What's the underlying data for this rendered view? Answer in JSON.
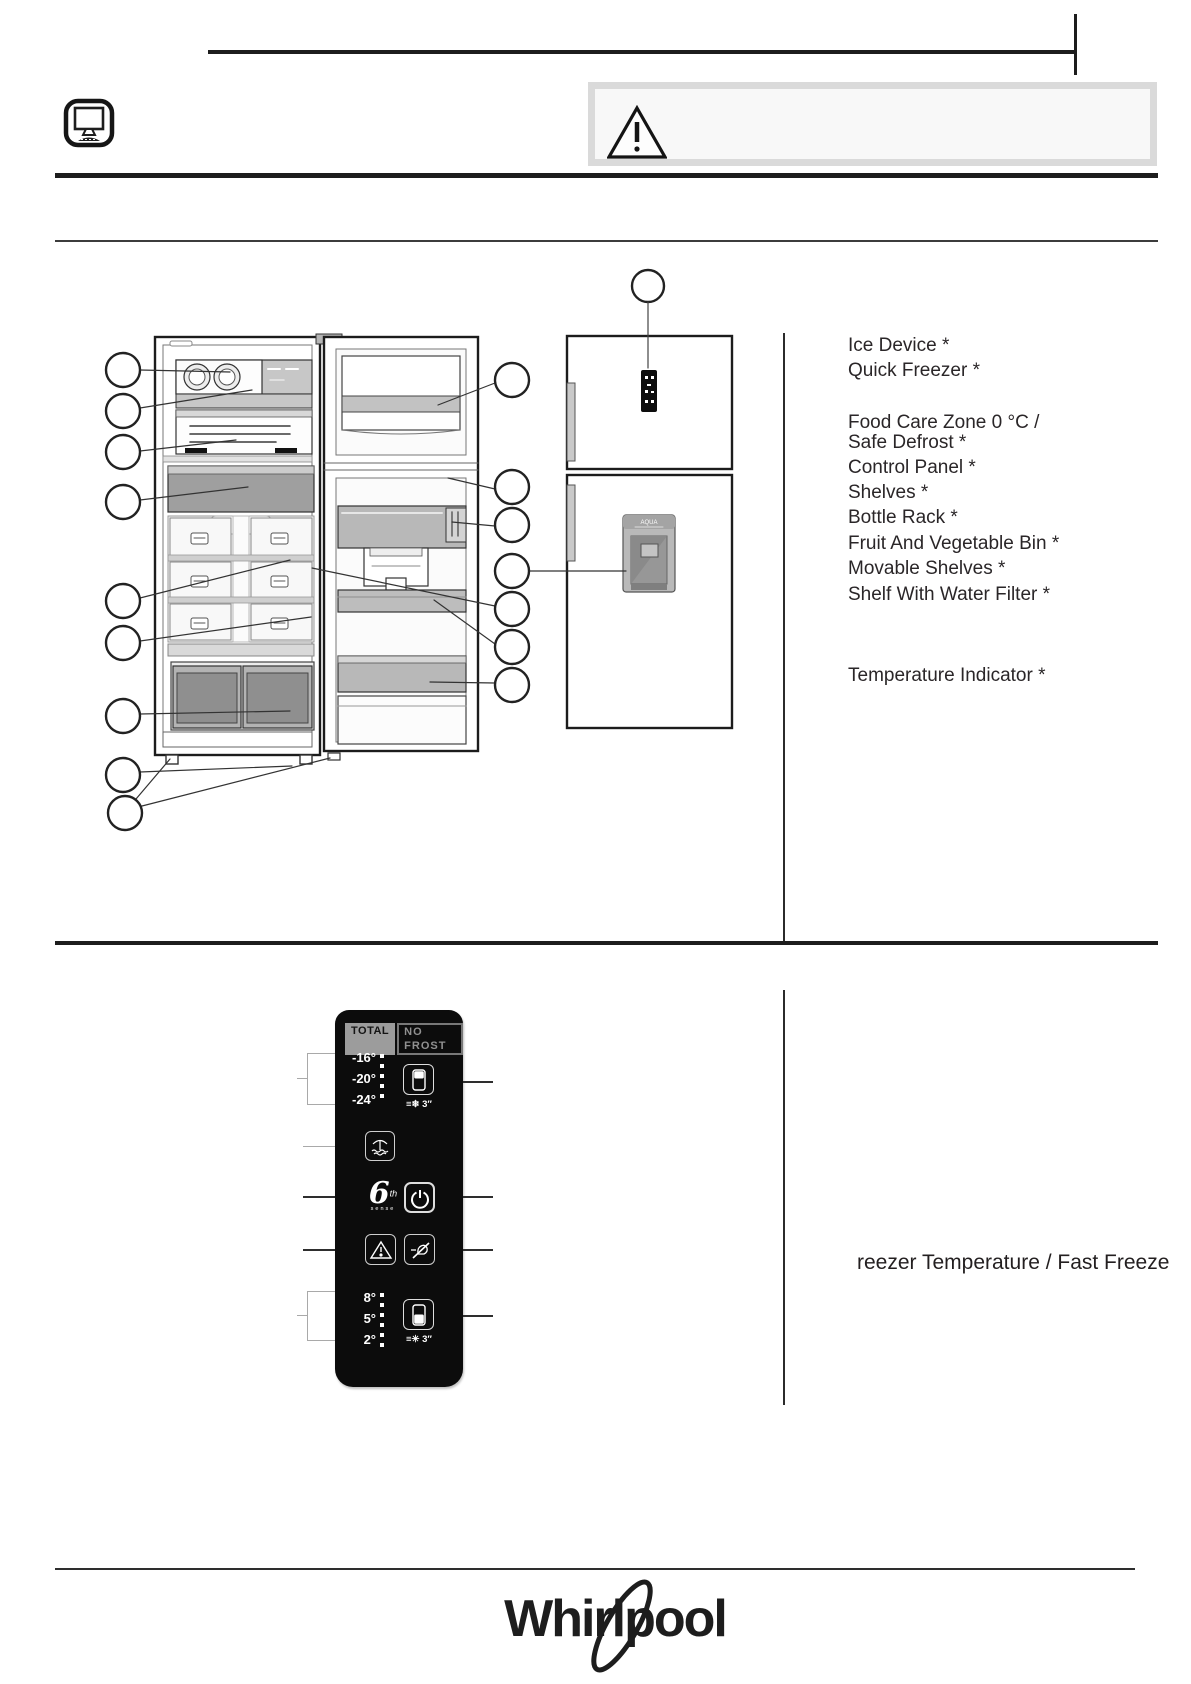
{
  "legend": {
    "items": [
      "Ice Device *",
      "Quick Freezer *",
      "Food Care Zone 0 °C /",
      "Safe Defrost *",
      "Control Panel *",
      "Shelves *",
      "Bottle Rack *",
      "Fruit And Vegetable Bin *",
      "Movable Shelves *",
      "Shelf With Water Filter *",
      "Temperature Indicator *"
    ]
  },
  "diagram": {
    "dispenser_label": "AQUA"
  },
  "control_panel": {
    "badge_total": "TOTAL",
    "badge_no_frost": "NO FROST",
    "freezer_temps": [
      "-16°",
      "-20°",
      "-24°"
    ],
    "freezer_hold_label": "≡❄ 3″",
    "sixth_sense_6": "6",
    "sixth_sense_th": "th",
    "sixth_sense_sense": "sense",
    "fridge_temps": [
      "8°",
      "5°",
      "2°"
    ],
    "fridge_hold_label": "≡✳ 3″"
  },
  "captions": {
    "freezer_fast_freeze": "reezer Temperature / Fast Freeze"
  },
  "footer": {
    "brand": "Whirlpool"
  },
  "colors": {
    "panel_bg": "#0c0c0c",
    "divider": "#1d1d1d",
    "gray_fill": "#b9b9b9"
  }
}
